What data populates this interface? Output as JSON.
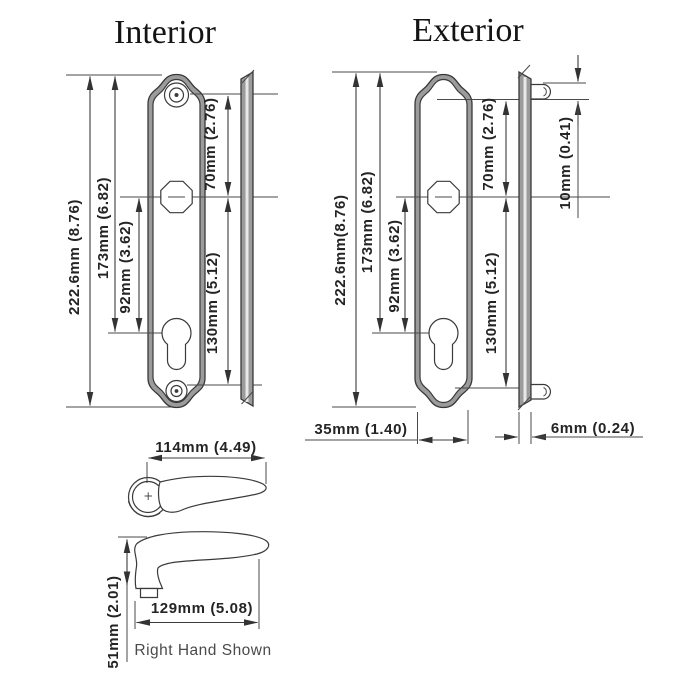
{
  "interior": {
    "title": "Interior",
    "dims": {
      "overall": "222.6mm (8.76)",
      "top_to_cylinder": "173mm (6.82)",
      "spindle_to_cylinder": "92mm (3.62)",
      "screw_to_spindle": "70mm (2.76)",
      "spindle_to_bottom": "130mm (5.12)"
    }
  },
  "exterior": {
    "title": "Exterior",
    "dims": {
      "overall": "222.6mm(8.76)",
      "top_to_cylinder": "173mm (6.82)",
      "spindle_to_cylinder": "92mm (3.62)",
      "screw_to_spindle": "70mm (2.76)",
      "spindle_to_bottom": "130mm (5.12)",
      "fixing_peg": "10mm (0.41)",
      "plate_width": "35mm (1.40)",
      "plate_thickness": "6mm (0.24)"
    }
  },
  "lever": {
    "dims": {
      "grip_length": "114mm (4.49)",
      "overall_length": "129mm (5.08)",
      "projection": "51mm (2.01)"
    },
    "caption": "Right Hand Shown"
  },
  "colors": {
    "metal_gray": "#9b9b9b",
    "line": "#3c3c3c",
    "text": "#242424"
  }
}
